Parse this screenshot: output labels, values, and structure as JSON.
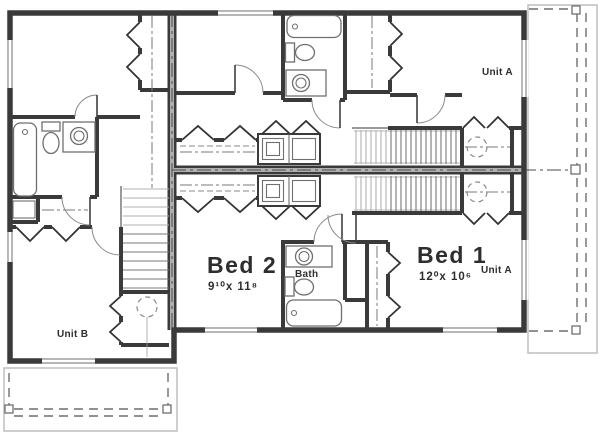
{
  "floor_plan": {
    "units": {
      "unit_a_upper_label": "Unit A",
      "unit_a_lower_label": "Unit A",
      "unit_b_label": "Unit B"
    },
    "rooms": {
      "bed1": {
        "name": "Bed 1",
        "dimensions": "12⁰x 10⁶"
      },
      "bed2": {
        "name": "Bed 2",
        "dimensions": "9¹⁰x 11⁸"
      },
      "bath": {
        "name": "Bath"
      }
    },
    "colors": {
      "wall": "#3a3a3a",
      "party": "#b0b0b0",
      "fixture": "#6f6f6f",
      "deck": "#bdbdbd",
      "text-color": "#2e2e2e",
      "bg": "#ffffff"
    }
  }
}
